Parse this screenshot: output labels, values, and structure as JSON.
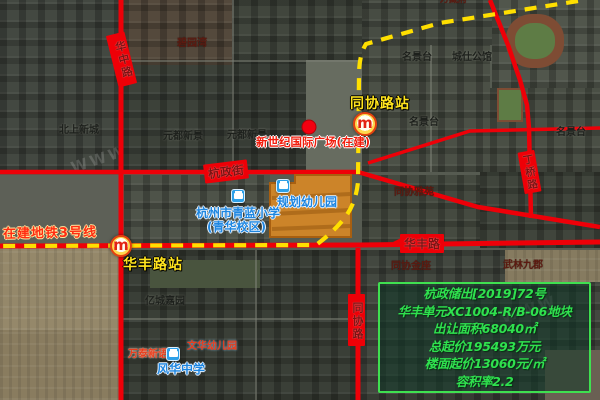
{
  "stations": {
    "tongxie": "同协路站",
    "huafeng": "华丰路站",
    "line3": "在建地铁3号线"
  },
  "roads": {
    "huazhong": "华中路",
    "hangzheng": "杭政街",
    "dingqiao": "丁桥路",
    "huafeng": "华丰路",
    "tongxie": "同协路"
  },
  "poi": {
    "wanzangfu": "万藏府",
    "biyuanwan": "碧园湾",
    "mingjingtai_1": "名景台",
    "chengshi_gongguan": "城仕公馆",
    "mingjingtai_2": "名景台",
    "mingjingtai_3": "名景台",
    "beishang_xincheng": "北上新城",
    "yuandu_xinjing_1": "元都新景",
    "yuandu_xinjing_2": "元都新景",
    "xinshiji_plaza": "新世纪国际广场(在建)",
    "tongxie_yayuan": "同协雅苑",
    "qinglan_line1": "杭州市青蓝小学",
    "qinglan_line2": "(青华校区)",
    "guihua_kindergarten": "规划幼儿园",
    "yicheng_jiayuan": "亿城嘉园",
    "tongxie_jinzuo": "同协金座",
    "wulin_jiujun": "武林九郡",
    "wantai_xinyu": "万泰新语",
    "wenhua_kindergarten": "文华幼儿园",
    "fenghua_middle": "风华中学"
  },
  "parcel": {
    "fill": "rgba(224,140,34,0.85)",
    "stroke": "#a85f10"
  },
  "info_box": {
    "lines": [
      "杭政储出[2019]72号",
      "华丰单元XC1004-R/B-06地块",
      "出让面积68040㎡",
      "总起价195493万元",
      "楼面起价13060元/㎡",
      "容积率2.2"
    ],
    "text_color": "#2fe14e",
    "border_color": "#3fe050"
  },
  "icons": {
    "metro_letter": "m"
  },
  "colors": {
    "road_red": "#ee0008",
    "metro_line_yellow": "#ffdf00",
    "station_text_yellow": "#ffe41e"
  },
  "watermark": "WWW"
}
